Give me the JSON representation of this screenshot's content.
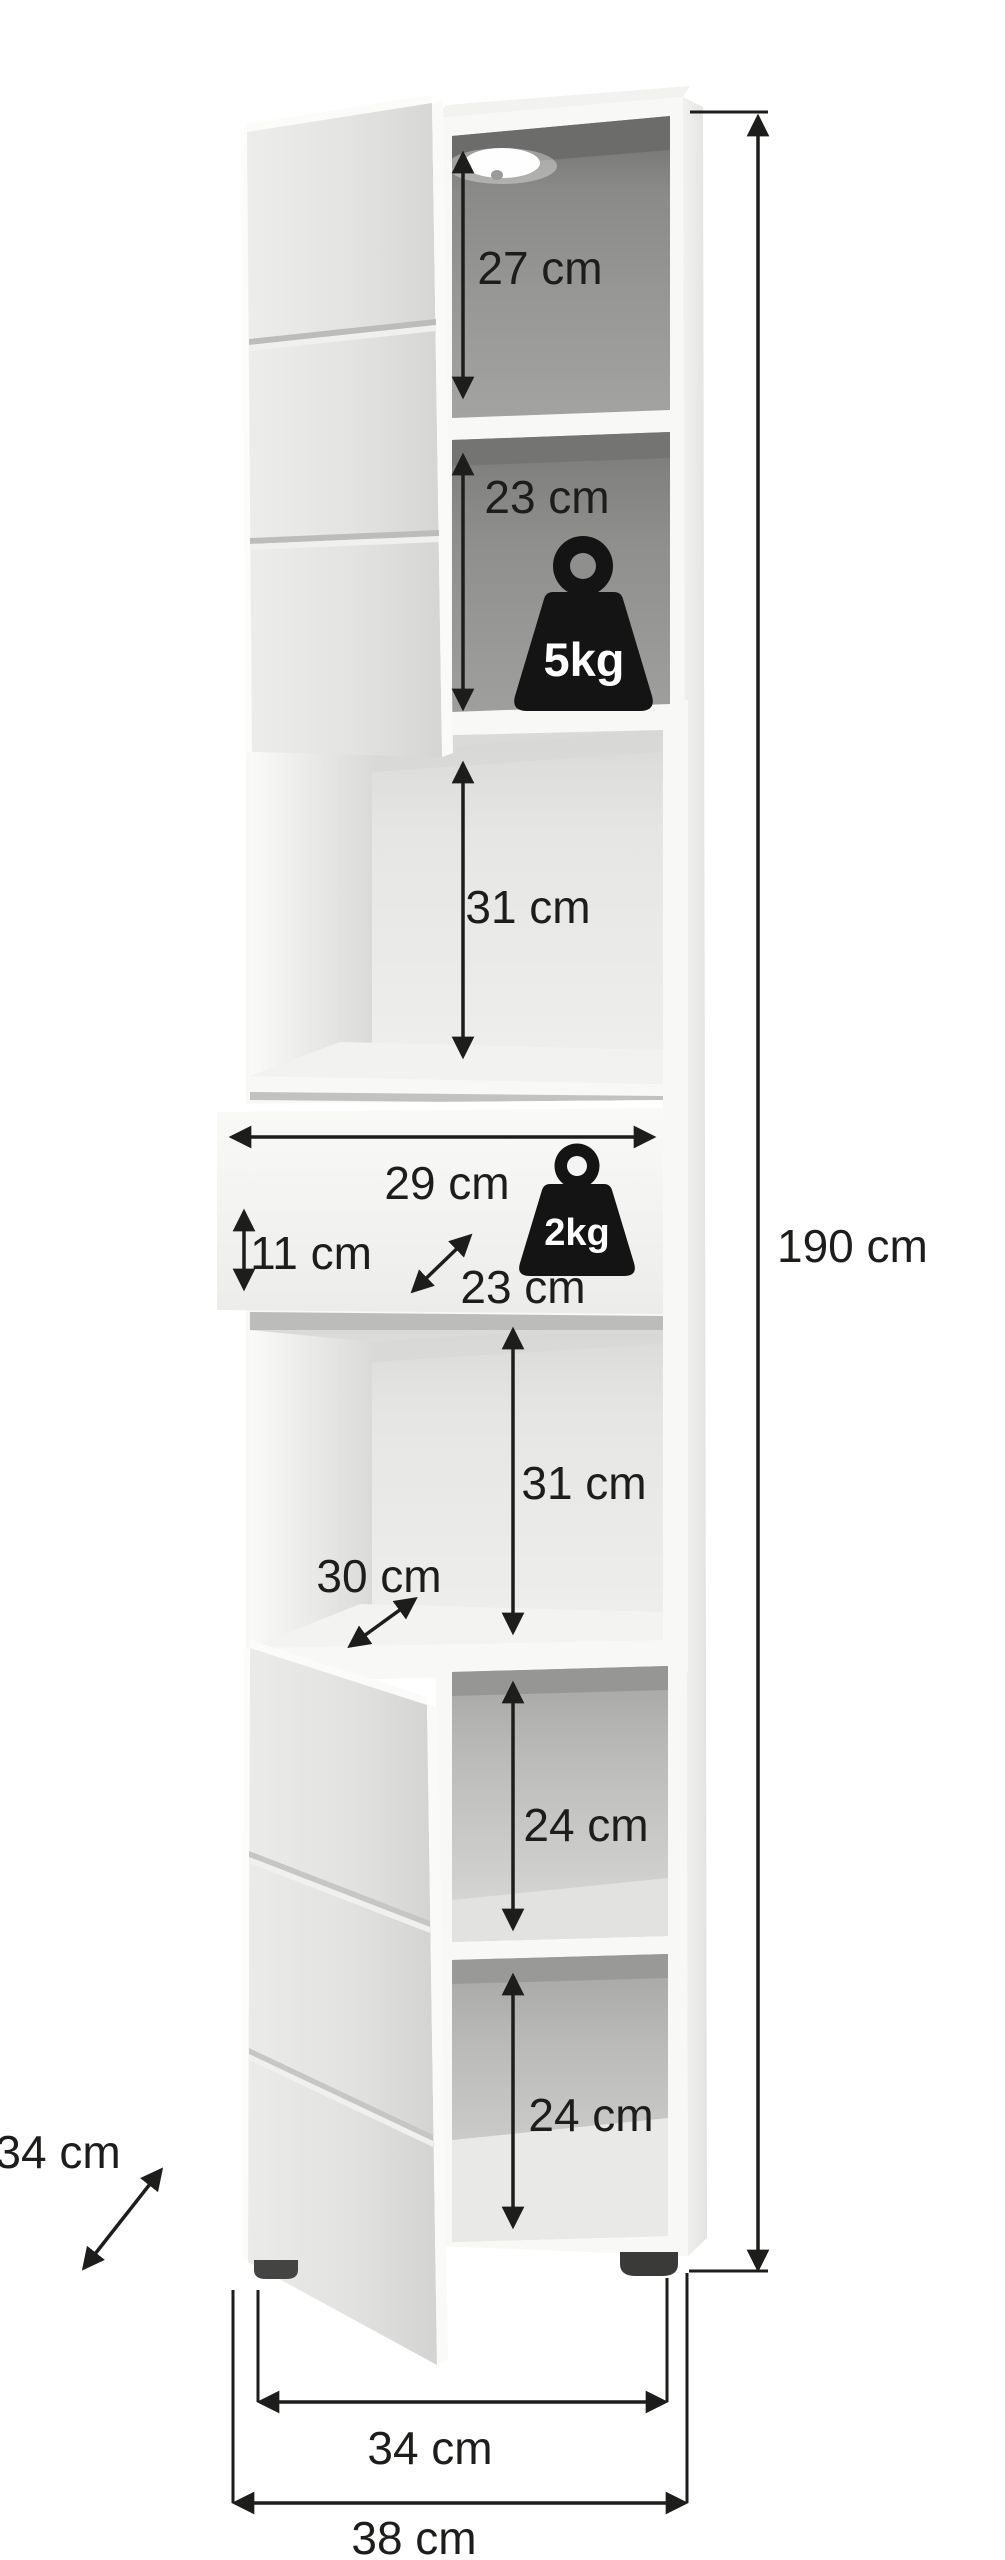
{
  "diagram": {
    "type": "furniture dimension diagram",
    "item": "tall cabinet with two open doors and one open drawer"
  },
  "colors": {
    "background": "#ffffff",
    "annotation": "#1d1d1b",
    "cabinet_white": "#f8f8f6",
    "door_gray": "#e4e4e2",
    "interior_dark": "#8e8e8c",
    "interior_light": "#ebebe9",
    "weight_badge": "#141414",
    "weight_label": "#ffffff",
    "foot": "#3d3d3b"
  },
  "dimensions": {
    "overall_height": "190 cm",
    "overall_width": "38 cm",
    "inner_width": "34 cm",
    "depth": "34 cm",
    "compartments": [
      {
        "name": "top shelf",
        "height": "27 cm"
      },
      {
        "name": "second shelf",
        "height": "23 cm",
        "max_load": "5kg"
      },
      {
        "name": "third shelf",
        "height": "31 cm"
      },
      {
        "name": "drawer",
        "width": "29 cm",
        "front_height": "11 cm",
        "depth": "23 cm",
        "max_load": "2kg"
      },
      {
        "name": "fourth shelf",
        "height": "31 cm",
        "depth": "30 cm"
      },
      {
        "name": "fifth shelf",
        "height": "24 cm"
      },
      {
        "name": "sixth shelf",
        "height": "24 cm"
      }
    ]
  }
}
